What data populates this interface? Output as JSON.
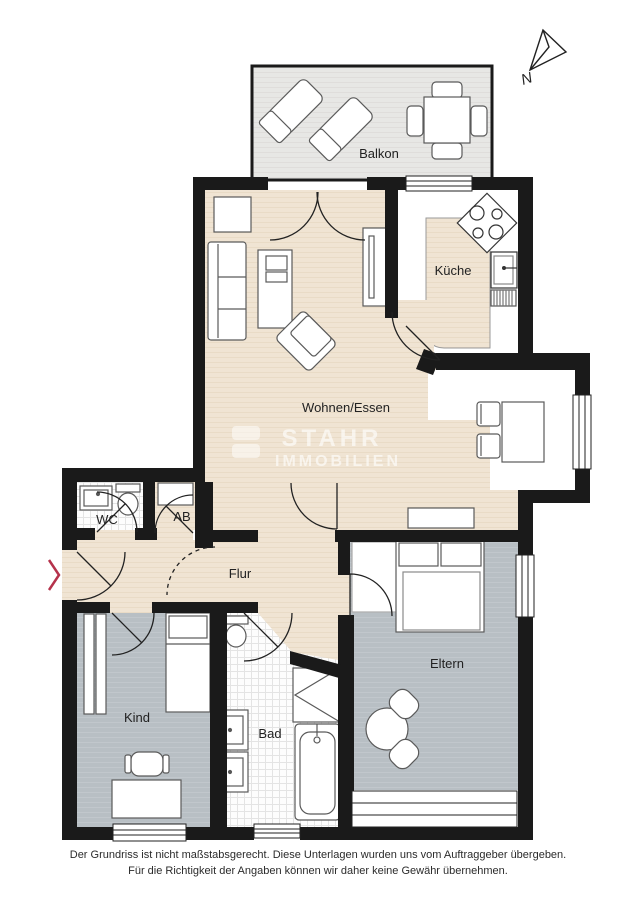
{
  "compass": {
    "label": "N"
  },
  "rooms": {
    "balkon": "Balkon",
    "kueche": "Küche",
    "wohnen_essen": "Wohnen/Essen",
    "wc": "WC",
    "ab": "AB",
    "flur": "Flur",
    "kind": "Kind",
    "bad": "Bad",
    "eltern": "Eltern"
  },
  "watermark": {
    "line1": "STAHR",
    "line2": "IMMOBILIEN"
  },
  "disclaimer": {
    "line1": "Der Grundriss ist nicht maßstabsgerecht. Diese Unterlagen wurden uns vom Auftraggeber übergeben.",
    "line2": "Für die Richtigkeit der Angaben können wir daher keine Gewähr übernehmen."
  },
  "colors": {
    "wall": "#1a1a1a",
    "wood_floor": "#f0e4d3",
    "gray_floor": "#b8bfc4",
    "balcony_floor": "#e7e7e5",
    "entrance_marker": "#b5324b"
  }
}
